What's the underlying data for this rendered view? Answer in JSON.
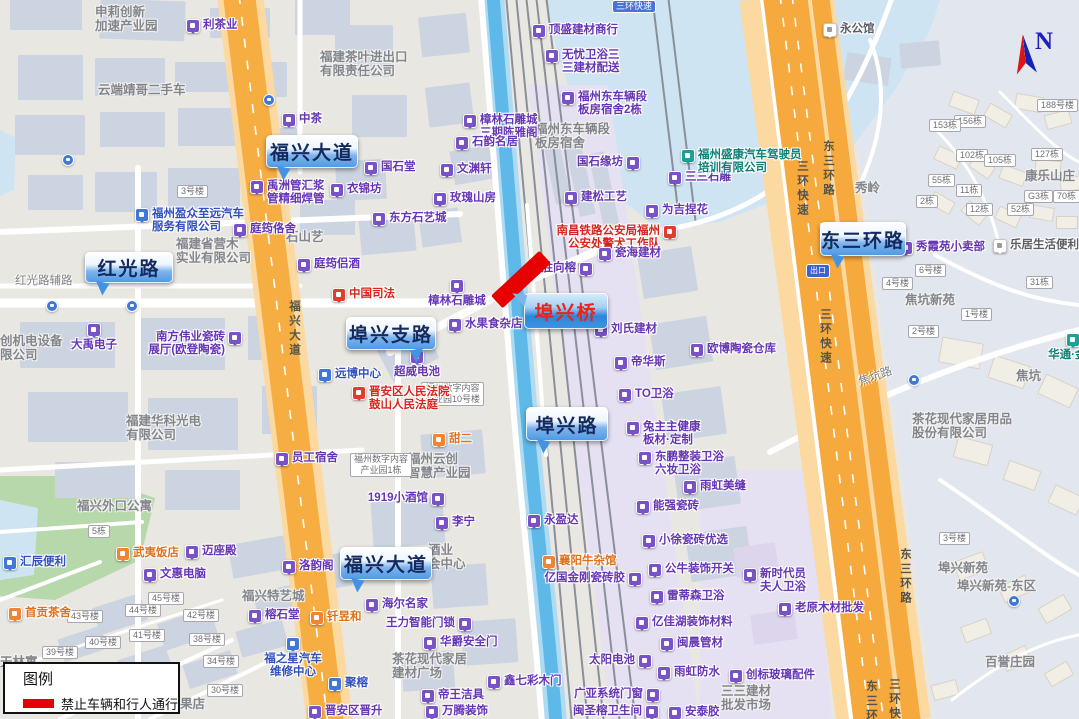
{
  "legend": {
    "title": "图例",
    "items": [
      {
        "color": "#e60000",
        "label": "禁止车辆和行人通行"
      }
    ]
  },
  "compass": {
    "label": "N"
  },
  "closure": {
    "color": "#e60000"
  },
  "colors": {
    "water": "#cfe4f3",
    "canal": "#5fb9e8",
    "highway_orange": "#f6a93c",
    "lavender": "#e6e0f3",
    "green": "#b7d8ab",
    "callout_text": "#14295e",
    "callout_alert_text": "#e8231a"
  },
  "map": {
    "callouts": [
      {
        "id": "fuxing-avenue-north",
        "t": "福兴大道",
        "x": 266,
        "y": 135,
        "w": 92,
        "h": 33,
        "tail": "bl"
      },
      {
        "id": "hongguang-road",
        "t": "红光路",
        "x": 85,
        "y": 252,
        "w": 88,
        "h": 31,
        "tail": "bl"
      },
      {
        "id": "buxing-branch-road",
        "t": "埠兴支路",
        "x": 346,
        "y": 317,
        "w": 90,
        "h": 33,
        "tail": "br"
      },
      {
        "id": "buxing-bridge",
        "t": "埠兴桥",
        "x": 524,
        "y": 293,
        "w": 84,
        "h": 36,
        "tail": "tl",
        "variant": "alert"
      },
      {
        "id": "buxing-road",
        "t": "埠兴路",
        "x": 526,
        "y": 407,
        "w": 82,
        "h": 34,
        "tail": "bl"
      },
      {
        "id": "east-third-ring-road",
        "t": "东三环路",
        "x": 820,
        "y": 222,
        "w": 86,
        "h": 34,
        "tail": "bl"
      },
      {
        "id": "fuxing-avenue-south",
        "t": "福兴大道",
        "x": 340,
        "y": 547,
        "w": 92,
        "h": 33,
        "tail": "bl"
      }
    ],
    "pois": [
      {
        "t": "利茶业",
        "x": 186,
        "y": 19
      },
      {
        "t": "中茶",
        "x": 282,
        "y": 113
      },
      {
        "t": "禹洲管汇浆\n管精细焊管",
        "x": 250,
        "y": 180
      },
      {
        "t": "衣锦坊",
        "x": 330,
        "y": 183
      },
      {
        "t": "大禹电子",
        "x": 87,
        "y": 323,
        "lp": "b"
      },
      {
        "t": "南方伟业瓷砖\n展厅(欧登陶瓷)",
        "x": 228,
        "y": 331,
        "lp": "l"
      },
      {
        "t": "员工宿舍",
        "x": 275,
        "y": 452
      },
      {
        "t": "顶盛建材商行",
        "x": 532,
        "y": 24
      },
      {
        "t": "无忧卫浴三\n三建材配送",
        "x": 545,
        "y": 49
      },
      {
        "t": "福州东车辆段\n板房宿舍2栋",
        "x": 561,
        "y": 91
      },
      {
        "t": "樟林石雕城\n三期陈雅阁",
        "x": 463,
        "y": 114
      },
      {
        "t": "石韵名居",
        "x": 455,
        "y": 136
      },
      {
        "t": "国石堂",
        "x": 364,
        "y": 161
      },
      {
        "t": "文渊轩",
        "x": 440,
        "y": 163
      },
      {
        "t": "玫瑰山房",
        "x": 433,
        "y": 192
      },
      {
        "t": "东方石艺城",
        "x": 372,
        "y": 212
      },
      {
        "t": "国石缘坊",
        "x": 626,
        "y": 156,
        "lp": "l"
      },
      {
        "t": "三三石雕",
        "x": 668,
        "y": 171
      },
      {
        "t": "建松工艺",
        "x": 564,
        "y": 191
      },
      {
        "t": "为吉捏花",
        "x": 645,
        "y": 204
      },
      {
        "t": "南昌铁路公安局福州\n公安处警犬工作队",
        "x": 663,
        "y": 225,
        "ic": "red",
        "lp": "l"
      },
      {
        "t": "瓷海建材",
        "x": 598,
        "y": 247
      },
      {
        "t": "胜向榕",
        "x": 579,
        "y": 262,
        "lp": "l"
      },
      {
        "t": "刘氏建材",
        "x": 594,
        "y": 323
      },
      {
        "t": "帝华斯",
        "x": 614,
        "y": 356
      },
      {
        "t": "欧博陶瓷仓库",
        "x": 690,
        "y": 343
      },
      {
        "t": "TO卫浴",
        "x": 618,
        "y": 388
      },
      {
        "t": "兔主主健康\n板材·定制",
        "x": 626,
        "y": 421
      },
      {
        "t": "东鹏整装卫浴\n六妆卫浴",
        "x": 638,
        "y": 451
      },
      {
        "t": "雨虹美缝",
        "x": 683,
        "y": 480
      },
      {
        "t": "能强瓷砖",
        "x": 636,
        "y": 500
      },
      {
        "t": "小徐瓷砖优选",
        "x": 642,
        "y": 534
      },
      {
        "t": "公牛装饰开关",
        "x": 648,
        "y": 563
      },
      {
        "t": "雷蒂森卫浴",
        "x": 650,
        "y": 590
      },
      {
        "t": "亿佳湖装饰材料",
        "x": 635,
        "y": 616
      },
      {
        "t": "闽晨管材",
        "x": 660,
        "y": 637
      },
      {
        "t": "太阳电池",
        "x": 638,
        "y": 654,
        "lp": "l"
      },
      {
        "t": "雨虹防水",
        "x": 657,
        "y": 666
      },
      {
        "t": "广亚系统门窗",
        "x": 646,
        "y": 688,
        "lp": "l"
      },
      {
        "t": "闽圣榕卫生间",
        "x": 645,
        "y": 705,
        "lp": "l"
      },
      {
        "t": "安泰胶",
        "x": 668,
        "y": 706
      },
      {
        "t": "亿国金刚瓷砖胶",
        "x": 628,
        "y": 572,
        "lp": "l"
      },
      {
        "t": "永盈达",
        "x": 527,
        "y": 514
      },
      {
        "t": "襄阳牛杂馆",
        "x": 542,
        "y": 555,
        "ic": "orange"
      },
      {
        "t": "1919小酒馆",
        "x": 431,
        "y": 492,
        "lp": "l"
      },
      {
        "t": "李宁",
        "x": 435,
        "y": 516
      },
      {
        "t": "海尔名家",
        "x": 365,
        "y": 598
      },
      {
        "t": "王力智能门锁",
        "x": 458,
        "y": 617,
        "lp": "l"
      },
      {
        "t": "华爵安全门",
        "x": 423,
        "y": 636
      },
      {
        "t": "鑫七彩木门",
        "x": 487,
        "y": 675
      },
      {
        "t": "帝王洁具",
        "x": 421,
        "y": 689
      },
      {
        "t": "万腾装饰",
        "x": 425,
        "y": 705
      },
      {
        "t": "樟林石雕城",
        "x": 450,
        "y": 279,
        "lp": "b"
      },
      {
        "t": "水果食杂店",
        "x": 448,
        "y": 318
      },
      {
        "t": "超威电池",
        "x": 410,
        "y": 350,
        "lp": "b"
      },
      {
        "t": "中国司法",
        "x": 332,
        "y": 288,
        "ic": "red"
      },
      {
        "t": "新时代员\n夫人卫浴",
        "x": 743,
        "y": 568
      },
      {
        "t": "老原木材批发",
        "x": 778,
        "y": 602
      },
      {
        "t": "创标玻璃配件",
        "x": 729,
        "y": 669
      },
      {
        "t": "秀霞苑小卖部",
        "x": 899,
        "y": 241
      },
      {
        "t": "乐居生活便利店",
        "x": 993,
        "y": 239,
        "ic": "white"
      },
      {
        "t": "洛韵阁",
        "x": 282,
        "y": 560
      },
      {
        "t": "榕石堂",
        "x": 248,
        "y": 609
      },
      {
        "t": "迈座殿",
        "x": 185,
        "y": 545
      },
      {
        "t": "文惠电脑",
        "x": 143,
        "y": 568
      },
      {
        "t": "庭筠佫舍",
        "x": 233,
        "y": 223
      },
      {
        "t": "庭筠侣酒",
        "x": 297,
        "y": 258
      },
      {
        "t": "武夷饭店",
        "x": 116,
        "y": 547,
        "ic": "orange"
      },
      {
        "t": "甜二",
        "x": 432,
        "y": 433,
        "ic": "orange"
      },
      {
        "t": "钎昱和",
        "x": 310,
        "y": 611,
        "ic": "orange"
      },
      {
        "t": "首贡茶舍",
        "x": 8,
        "y": 607,
        "ic": "orange"
      },
      {
        "t": "福州盈众至远汽车\n服务有限公司",
        "x": 135,
        "y": 208,
        "ic": "blue"
      },
      {
        "t": "福之星汽车\n维修中心",
        "x": 286,
        "y": 637,
        "ic": "blue",
        "lp": "b"
      },
      {
        "t": "汇辰便利",
        "x": 3,
        "y": 556,
        "ic": "blue"
      },
      {
        "t": "远博中心",
        "x": 318,
        "y": 368,
        "ic": "blue"
      },
      {
        "t": "聚榕",
        "x": 328,
        "y": 677,
        "ic": "blue"
      },
      {
        "t": "晋安区晋升",
        "x": 308,
        "y": 705
      },
      {
        "t": "福州盛康汽车驾驶员\n培训有限公司",
        "x": 681,
        "y": 149,
        "ic": "teal"
      },
      {
        "t": "华通·金豪",
        "x": 1066,
        "y": 333,
        "ic": "teal",
        "lp": "b"
      },
      {
        "t": "永公馆",
        "x": 823,
        "y": 23,
        "ic": "white"
      },
      {
        "t": "晋安区人民法院\n鼓山人民法庭",
        "x": 352,
        "y": 386,
        "ic": "red"
      }
    ],
    "areas": [
      {
        "t": "申莉创新\n加速产业园",
        "x": 95,
        "y": 5
      },
      {
        "t": "云端靖哥二手车",
        "x": 98,
        "y": 83
      },
      {
        "t": "福建茶叶进出口\n有限责任公司",
        "x": 320,
        "y": 50
      },
      {
        "t": "福建省营木\n实业有限公司",
        "x": 176,
        "y": 237
      },
      {
        "t": "创机电设备\n限公司",
        "x": 0,
        "y": 334
      },
      {
        "t": "福建华科光电\n有限公司",
        "x": 126,
        "y": 414
      },
      {
        "t": "石山艺",
        "x": 286,
        "y": 230
      },
      {
        "t": "福州东车辆段\n板房宿舍",
        "x": 535,
        "y": 122
      },
      {
        "t": "福兴外口公寓",
        "x": 77,
        "y": 499
      },
      {
        "t": "福兴特艺城",
        "x": 242,
        "y": 589
      },
      {
        "t": "茶花现代家居\n建材广场",
        "x": 392,
        "y": 652
      },
      {
        "t": "福州云创\n智慧产业园",
        "x": 408,
        "y": 452
      },
      {
        "t": "酒业\n会中心",
        "x": 428,
        "y": 543
      },
      {
        "t": "焦坑新苑",
        "x": 905,
        "y": 293
      },
      {
        "t": "康乐山庄",
        "x": 1025,
        "y": 169
      },
      {
        "t": "秀岭",
        "x": 855,
        "y": 181
      },
      {
        "t": "焦坑",
        "x": 1016,
        "y": 369
      },
      {
        "t": "茶花现代家居用品\n股份有限公司",
        "x": 912,
        "y": 412
      },
      {
        "t": "埠兴新苑",
        "x": 938,
        "y": 561
      },
      {
        "t": "埠兴新苑-东区",
        "x": 957,
        "y": 579
      },
      {
        "t": "百誉庄园",
        "x": 985,
        "y": 655
      },
      {
        "t": "三三建材\n批发市场",
        "x": 721,
        "y": 684
      },
      {
        "t": "天林寓",
        "x": 0,
        "y": 655
      },
      {
        "t": "果店",
        "x": 180,
        "y": 697
      }
    ],
    "roads": [
      {
        "t": "红光路辅路",
        "x": 15,
        "y": 272
      },
      {
        "t": "焦坑路",
        "x": 858,
        "y": 368,
        "rot": -20
      },
      {
        "t": "福兴大道",
        "x": 286,
        "y": 300,
        "v": 1,
        "onroad": 1
      },
      {
        "t": "三环快速",
        "x": 794,
        "y": 160,
        "v": 1,
        "onroad": 1
      },
      {
        "t": "东三环路",
        "x": 820,
        "y": 140,
        "v": 1,
        "onroad": 1
      },
      {
        "t": "三环快速",
        "x": 817,
        "y": 308,
        "v": 1,
        "onroad": 1
      },
      {
        "t": "东三环路",
        "x": 897,
        "y": 548,
        "v": 1,
        "onroad": 1
      },
      {
        "t": "东三环路",
        "x": 863,
        "y": 680,
        "v": 1,
        "onroad": 1
      },
      {
        "t": "三环快速",
        "x": 886,
        "y": 678,
        "v": 1,
        "onroad": 1
      }
    ],
    "boxes": [
      {
        "t": "3号楼",
        "x": 177,
        "y": 185
      },
      {
        "t": "5栋",
        "x": 88,
        "y": 525
      },
      {
        "t": "45号楼",
        "x": 148,
        "y": 592
      },
      {
        "t": "44号楼",
        "x": 125,
        "y": 604
      },
      {
        "t": "43号楼",
        "x": 67,
        "y": 610
      },
      {
        "t": "42号楼",
        "x": 183,
        "y": 609
      },
      {
        "t": "41号楼",
        "x": 129,
        "y": 629
      },
      {
        "t": "40号楼",
        "x": 85,
        "y": 636
      },
      {
        "t": "39号楼",
        "x": 42,
        "y": 646
      },
      {
        "t": "38号楼",
        "x": 189,
        "y": 633
      },
      {
        "t": "34号楼",
        "x": 203,
        "y": 655
      },
      {
        "t": "30号楼",
        "x": 207,
        "y": 684
      },
      {
        "t": "6号楼",
        "x": 915,
        "y": 264
      },
      {
        "t": "4号楼",
        "x": 882,
        "y": 277
      },
      {
        "t": "1号楼",
        "x": 961,
        "y": 308
      },
      {
        "t": "2号楼",
        "x": 908,
        "y": 325
      },
      {
        "t": "31栋",
        "x": 1026,
        "y": 276
      },
      {
        "t": "3号楼",
        "x": 939,
        "y": 532
      },
      {
        "t": "188号楼",
        "x": 1037,
        "y": 99
      },
      {
        "t": "156栋",
        "x": 954,
        "y": 115
      },
      {
        "t": "153栋",
        "x": 929,
        "y": 119
      },
      {
        "t": "102栋",
        "x": 956,
        "y": 149
      },
      {
        "t": "105栋",
        "x": 984,
        "y": 154
      },
      {
        "t": "127栋",
        "x": 1031,
        "y": 148
      },
      {
        "t": "55栋",
        "x": 928,
        "y": 174
      },
      {
        "t": "11栋",
        "x": 956,
        "y": 184
      },
      {
        "t": "G3栋",
        "x": 1024,
        "y": 190
      },
      {
        "t": "70栋",
        "x": 1053,
        "y": 190
      },
      {
        "t": "2栋",
        "x": 916,
        "y": 195
      },
      {
        "t": "12栋",
        "x": 966,
        "y": 203
      },
      {
        "t": "52栋",
        "x": 1007,
        "y": 203
      },
      {
        "t": "福州数字内容\n产业园10号楼",
        "x": 421,
        "y": 382
      },
      {
        "t": "福州数字内容\n产业园1栋",
        "x": 350,
        "y": 453
      }
    ],
    "badges": [
      {
        "ty": "exit",
        "t": "出口",
        "x": 806,
        "y": 264
      },
      {
        "ty": "shield",
        "t": "三环快速",
        "x": 612,
        "y": 0
      },
      {
        "ty": "bus",
        "x": 263,
        "y": 94
      },
      {
        "ty": "bus",
        "x": 62,
        "y": 154
      },
      {
        "ty": "bus",
        "x": 46,
        "y": 300
      },
      {
        "ty": "bus",
        "x": 126,
        "y": 300
      },
      {
        "ty": "bus",
        "x": 908,
        "y": 374
      },
      {
        "ty": "bus",
        "x": 1008,
        "y": 595
      }
    ]
  }
}
